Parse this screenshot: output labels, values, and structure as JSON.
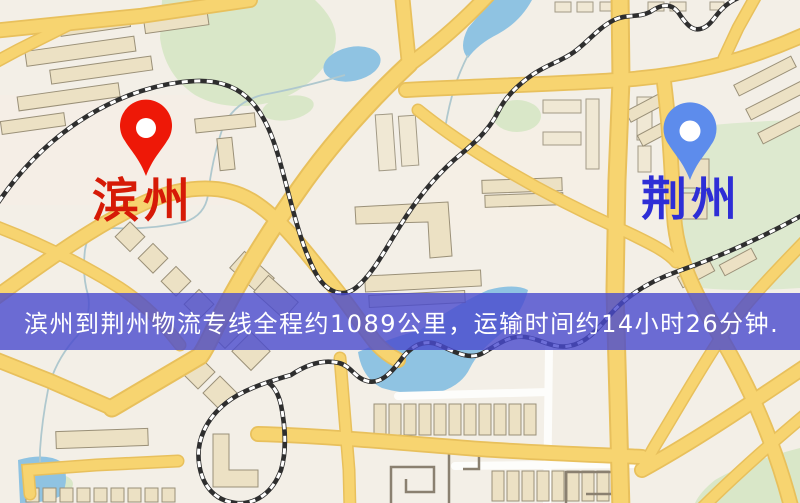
{
  "map": {
    "origin": {
      "label": "滨州",
      "pin_color": "#ee1807",
      "text_color": "#d61a07"
    },
    "destination": {
      "label": "荆州",
      "pin_color": "#5d8cec",
      "text_color": "#2e2ed6"
    },
    "banner": {
      "text": "滨州到荆州物流专线全程约1089公里，运输时间约14小时26分钟.",
      "bg_color": "#494ace",
      "text_color": "#ffffff"
    },
    "theme": {
      "background": "#f3efe7",
      "road": "#f7d470",
      "road_casing": "#e8c05c",
      "water": "#8fc3e2",
      "park": "#d9e7c8",
      "railway": "#2e2e2e",
      "building": "#ece1c4"
    }
  }
}
